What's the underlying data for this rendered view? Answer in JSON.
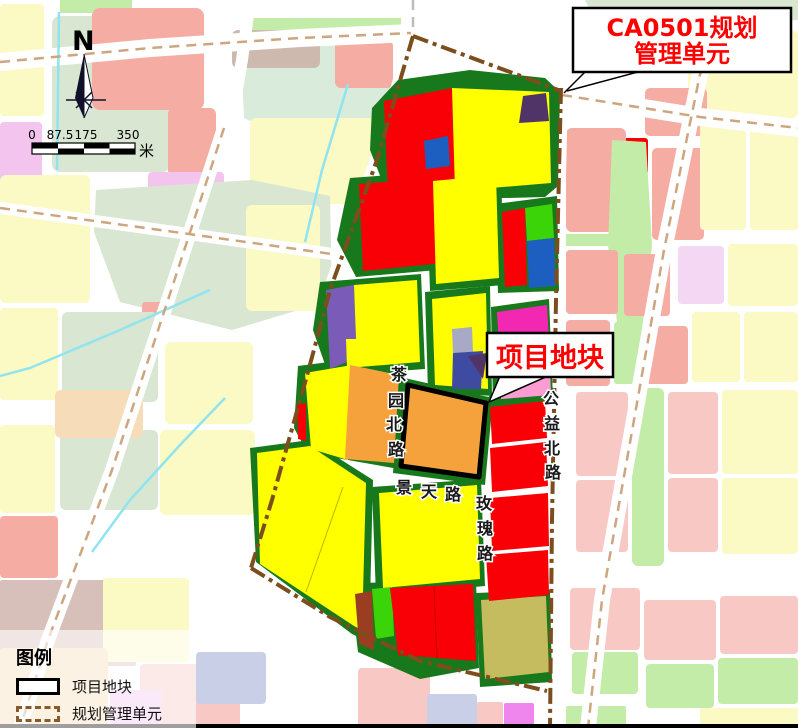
{
  "north": {
    "label": "N"
  },
  "scalebar": {
    "ticks": [
      "0",
      "87.5",
      "175",
      "350"
    ],
    "unit": "米"
  },
  "legend": {
    "title": "图例",
    "items": [
      {
        "symbol": "project-outline",
        "label": "项目地块"
      },
      {
        "symbol": "unit-dash",
        "label": "规划管理单元"
      }
    ]
  },
  "annotations": {
    "unit_box": {
      "lines": [
        "CA0501规划",
        "管理单元"
      ],
      "leaders": [
        [
          585,
          72,
          564,
          93
        ],
        [
          638,
          72,
          567,
          91
        ]
      ]
    },
    "project_box": {
      "text": "项目地块",
      "tail": "500,376 548,376 489,402"
    }
  },
  "labels": {
    "roads": [
      {
        "name": "茶园北路",
        "chars": [
          [
            "茶",
            399,
            374
          ],
          [
            "园",
            396,
            400
          ],
          [
            "北",
            394,
            424
          ],
          [
            "路",
            396,
            449
          ]
        ]
      },
      {
        "name": "景天路",
        "chars": [
          [
            "景",
            404,
            487
          ],
          [
            "天",
            429,
            491
          ],
          [
            "路",
            453,
            494
          ]
        ]
      },
      {
        "name": "玫瑰路",
        "chars": [
          [
            "玫",
            484,
            503
          ],
          [
            "瑰",
            485,
            528
          ],
          [
            "路",
            485,
            553
          ]
        ]
      },
      {
        "name": "公益北路",
        "chars": [
          [
            "公",
            551,
            398
          ],
          [
            "益",
            552,
            423
          ],
          [
            "北",
            552,
            448
          ],
          [
            "路",
            553,
            472
          ]
        ]
      }
    ]
  },
  "palette": {
    "paleYellow": "#FBF9C4",
    "sage": "#D9E6D2",
    "salmon": "#F5ACA3",
    "pinkLight": "#F8C8C4",
    "dustyRose": "#D8C0BA",
    "orchid": "#F2C4EE",
    "violet": "#EE86EE",
    "peach": "#F6DCB8",
    "lavender": "#C9CFE6",
    "taupe": "#CDB9AE",
    "mint": "#D9ECDC",
    "lightGreen": "#C2ECA8",
    "paleViolet": "#F4D7F3",
    "yellow": "#FFFF00",
    "red": "#F90006",
    "orange": "#F5A23C",
    "greenBand": "#17781C",
    "brightGreen": "#3BD409",
    "blue": "#1C5FC0",
    "purple": "#7A5CB8",
    "darkPurple": "#503468",
    "slateBlue": "#3F4BA0",
    "grayLav": "#A7A9C5",
    "magenta": "#F328B2",
    "pink": "#FB9CD2",
    "olive": "#C5BC60",
    "brown": "#9A3D20",
    "boundary": "#7C4E1D",
    "tanRoad": "#CDA57E",
    "stream": "#8FE4EF",
    "labelRed": "#FF0000"
  },
  "map": {
    "bg_parcels": [
      {
        "t": "rect",
        "x": 60,
        "y": 0,
        "w": 72,
        "h": 13,
        "f": "lightGreen"
      },
      {
        "t": "rect",
        "x": 0,
        "y": 4,
        "w": 44,
        "h": 112,
        "r": 4,
        "f": "paleYellow"
      },
      {
        "t": "rect",
        "x": 52,
        "y": 16,
        "w": 118,
        "h": 156,
        "r": 8,
        "f": "sage"
      },
      {
        "t": "rect",
        "x": 92,
        "y": 8,
        "w": 112,
        "h": 102,
        "r": 8,
        "f": "salmon"
      },
      {
        "t": "rect",
        "x": 168,
        "y": 108,
        "w": 48,
        "h": 68,
        "r": 6,
        "f": "salmon"
      },
      {
        "t": "rect",
        "x": 0,
        "y": 122,
        "w": 42,
        "h": 116,
        "r": 4,
        "f": "orchid"
      },
      {
        "t": "poly",
        "pts": "240,30 392,30 392,140 298,145 244,118",
        "f": "mint"
      },
      {
        "t": "rect",
        "x": 243,
        "y": 18,
        "w": 158,
        "h": 13,
        "f": "lightGreen"
      },
      {
        "t": "rect",
        "x": 232,
        "y": 30,
        "w": 88,
        "h": 38,
        "r": 6,
        "f": "taupe"
      },
      {
        "t": "rect",
        "x": 335,
        "y": 40,
        "w": 58,
        "h": 48,
        "r": 6,
        "f": "salmon"
      },
      {
        "t": "rect",
        "x": 250,
        "y": 118,
        "w": 148,
        "h": 86,
        "r": 6,
        "f": "paleYellow"
      },
      {
        "t": "rect",
        "x": 148,
        "y": 172,
        "w": 76,
        "h": 34,
        "r": 4,
        "f": "orchid"
      },
      {
        "t": "poly",
        "pts": "96,190 252,180 330,196 332,300 232,330 120,302 94,232",
        "f": "sage"
      },
      {
        "t": "rect",
        "x": 0,
        "y": 175,
        "w": 90,
        "h": 128,
        "r": 6,
        "f": "paleYellow"
      },
      {
        "t": "rect",
        "x": 246,
        "y": 205,
        "w": 74,
        "h": 106,
        "r": 6,
        "f": "paleYellow"
      },
      {
        "t": "rect",
        "x": 142,
        "y": 302,
        "w": 24,
        "h": 22,
        "r": 3,
        "f": "salmon"
      },
      {
        "t": "rect",
        "x": 0,
        "y": 308,
        "w": 58,
        "h": 92,
        "r": 4,
        "f": "paleYellow"
      },
      {
        "t": "rect",
        "x": 62,
        "y": 312,
        "w": 96,
        "h": 90,
        "r": 6,
        "f": "sage"
      },
      {
        "t": "rect",
        "x": 60,
        "y": 430,
        "w": 98,
        "h": 80,
        "r": 6,
        "f": "sage"
      },
      {
        "t": "rect",
        "x": 55,
        "y": 390,
        "w": 88,
        "h": 48,
        "r": 6,
        "f": "peach"
      },
      {
        "t": "rect",
        "x": 165,
        "y": 342,
        "w": 88,
        "h": 82,
        "r": 6,
        "f": "paleYellow"
      },
      {
        "t": "rect",
        "x": 160,
        "y": 430,
        "w": 95,
        "h": 85,
        "r": 6,
        "f": "paleYellow"
      },
      {
        "t": "rect",
        "x": 0,
        "y": 425,
        "w": 55,
        "h": 88,
        "r": 4,
        "f": "paleYellow"
      },
      {
        "t": "rect",
        "x": 0,
        "y": 516,
        "w": 58,
        "h": 62,
        "r": 4,
        "f": "salmon"
      },
      {
        "t": "rect",
        "x": 0,
        "y": 580,
        "w": 136,
        "h": 86,
        "r": 2,
        "f": "dustyRose"
      },
      {
        "t": "rect",
        "x": 103,
        "y": 578,
        "w": 86,
        "h": 84,
        "r": 4,
        "f": "paleYellow"
      },
      {
        "t": "rect",
        "x": 0,
        "y": 648,
        "w": 108,
        "h": 80,
        "r": 4,
        "f": "peach"
      },
      {
        "t": "rect",
        "x": 140,
        "y": 664,
        "w": 100,
        "h": 64,
        "r": 4,
        "f": "pinkLight"
      },
      {
        "t": "rect",
        "x": 196,
        "y": 652,
        "w": 70,
        "h": 52,
        "r": 4,
        "f": "lavender"
      },
      {
        "t": "rect",
        "x": 110,
        "y": 690,
        "w": 52,
        "h": 38,
        "r": 3,
        "f": "orchid"
      },
      {
        "t": "rect",
        "x": 358,
        "y": 668,
        "w": 72,
        "h": 60,
        "r": 4,
        "f": "pinkLight"
      },
      {
        "t": "rect",
        "x": 427,
        "y": 694,
        "w": 50,
        "h": 34,
        "r": 3,
        "f": "lavender"
      },
      {
        "t": "rect",
        "x": 477,
        "y": 702,
        "w": 26,
        "h": 26,
        "r": 2,
        "f": "pinkLight"
      },
      {
        "t": "rect",
        "x": 504,
        "y": 703,
        "w": 30,
        "h": 25,
        "r": 2,
        "f": "violet"
      },
      {
        "t": "poly",
        "pts": "585,0 798,0 798,20 600,30",
        "f": "sage"
      },
      {
        "t": "rect",
        "x": 688,
        "y": 30,
        "w": 110,
        "h": 88,
        "r": 6,
        "f": "paleYellow"
      },
      {
        "t": "rect",
        "x": 645,
        "y": 88,
        "w": 62,
        "h": 48,
        "r": 5,
        "f": "salmon"
      },
      {
        "t": "rect",
        "x": 598,
        "y": 138,
        "w": 50,
        "h": 36,
        "r": 3,
        "f": "red"
      },
      {
        "t": "rect",
        "x": 566,
        "y": 128,
        "w": 60,
        "h": 104,
        "r": 6,
        "f": "salmon"
      },
      {
        "t": "rect",
        "x": 566,
        "y": 234,
        "w": 60,
        "h": 12,
        "f": "lightGreen"
      },
      {
        "t": "poly",
        "pts": "612,140 646,142 652,246 642,330 618,330 608,246",
        "f": "lightGreen"
      },
      {
        "t": "rect",
        "x": 652,
        "y": 148,
        "w": 52,
        "h": 92,
        "r": 5,
        "f": "salmon"
      },
      {
        "t": "rect",
        "x": 700,
        "y": 120,
        "w": 46,
        "h": 110,
        "r": 4,
        "f": "paleYellow"
      },
      {
        "t": "rect",
        "x": 750,
        "y": 122,
        "w": 48,
        "h": 108,
        "r": 4,
        "f": "paleYellow"
      },
      {
        "t": "rect",
        "x": 566,
        "y": 250,
        "w": 52,
        "h": 64,
        "r": 4,
        "f": "salmon"
      },
      {
        "t": "rect",
        "x": 624,
        "y": 254,
        "w": 46,
        "h": 62,
        "r": 4,
        "f": "salmon"
      },
      {
        "t": "rect",
        "x": 678,
        "y": 246,
        "w": 46,
        "h": 58,
        "r": 4,
        "f": "paleViolet"
      },
      {
        "t": "rect",
        "x": 728,
        "y": 244,
        "w": 70,
        "h": 62,
        "r": 4,
        "f": "paleYellow"
      },
      {
        "t": "rect",
        "x": 566,
        "y": 320,
        "w": 44,
        "h": 66,
        "r": 4,
        "f": "salmon"
      },
      {
        "t": "rect",
        "x": 614,
        "y": 322,
        "w": 28,
        "h": 62,
        "r": 3,
        "f": "lightGreen"
      },
      {
        "t": "rect",
        "x": 646,
        "y": 326,
        "w": 42,
        "h": 58,
        "r": 4,
        "f": "salmon"
      },
      {
        "t": "rect",
        "x": 692,
        "y": 312,
        "w": 48,
        "h": 70,
        "r": 4,
        "f": "paleYellow"
      },
      {
        "t": "rect",
        "x": 744,
        "y": 312,
        "w": 54,
        "h": 70,
        "r": 4,
        "f": "paleYellow"
      },
      {
        "t": "rect",
        "x": 576,
        "y": 392,
        "w": 52,
        "h": 84,
        "r": 4,
        "f": "pinkLight"
      },
      {
        "t": "rect",
        "x": 632,
        "y": 388,
        "w": 32,
        "h": 178,
        "r": 6,
        "f": "lightGreen"
      },
      {
        "t": "rect",
        "x": 668,
        "y": 392,
        "w": 50,
        "h": 82,
        "r": 4,
        "f": "pinkLight"
      },
      {
        "t": "rect",
        "x": 722,
        "y": 390,
        "w": 76,
        "h": 84,
        "r": 4,
        "f": "paleYellow"
      },
      {
        "t": "rect",
        "x": 576,
        "y": 480,
        "w": 52,
        "h": 72,
        "r": 4,
        "f": "pinkLight"
      },
      {
        "t": "rect",
        "x": 668,
        "y": 478,
        "w": 50,
        "h": 74,
        "r": 4,
        "f": "pinkLight"
      },
      {
        "t": "rect",
        "x": 722,
        "y": 478,
        "w": 76,
        "h": 76,
        "r": 4,
        "f": "paleYellow"
      },
      {
        "t": "rect",
        "x": 570,
        "y": 588,
        "w": 70,
        "h": 62,
        "r": 4,
        "f": "pinkLight"
      },
      {
        "t": "rect",
        "x": 572,
        "y": 652,
        "w": 66,
        "h": 42,
        "r": 4,
        "f": "lightGreen"
      },
      {
        "t": "rect",
        "x": 644,
        "y": 600,
        "w": 72,
        "h": 60,
        "r": 4,
        "f": "pinkLight"
      },
      {
        "t": "rect",
        "x": 646,
        "y": 664,
        "w": 68,
        "h": 44,
        "r": 4,
        "f": "lightGreen"
      },
      {
        "t": "rect",
        "x": 720,
        "y": 596,
        "w": 78,
        "h": 58,
        "r": 4,
        "f": "pinkLight"
      },
      {
        "t": "rect",
        "x": 718,
        "y": 658,
        "w": 80,
        "h": 46,
        "r": 4,
        "f": "lightGreen"
      },
      {
        "t": "rect",
        "x": 566,
        "y": 706,
        "w": 60,
        "h": 22,
        "r": 2,
        "f": "lightGreen"
      },
      {
        "t": "rect",
        "x": 700,
        "y": 708,
        "w": 98,
        "h": 20,
        "r": 2,
        "f": "paleYellow"
      }
    ],
    "roads_white": [
      {
        "pts": "0,62 150,48 300,38 411,33",
        "w": 18
      },
      {
        "pts": "562,95 700,117 798,128",
        "w": 18
      },
      {
        "pts": "224,128 168,300 112,470 48,640 20,728",
        "w": 14
      },
      {
        "pts": "0,208 160,230 332,254",
        "w": 12
      },
      {
        "pts": "705,50 664,250 634,420 602,600 588,728",
        "w": 16
      },
      {
        "pts": "250,0 242,60 230,130",
        "w": 12
      },
      {
        "pts": "413,0 413,33",
        "w": 16
      },
      {
        "pts": "250,568 330,616 420,660 548,692",
        "w": 16
      },
      {
        "pts": "413,34 377,160 330,290 308,372 272,500 252,568",
        "w": 14
      },
      {
        "pts": "561,88 554,400 550,728",
        "w": 14
      }
    ],
    "streams": [
      {
        "pts": "59,12 57,170"
      },
      {
        "pts": "348,84 322,170 305,242"
      },
      {
        "pts": "210,290 120,330 30,368 0,376"
      },
      {
        "pts": "225,398 180,445 130,500 92,552"
      }
    ],
    "road_dashes": [
      {
        "pts": "0,62 150,48 300,38 411,33",
        "c": "tanRoad"
      },
      {
        "pts": "562,95 700,117 798,128",
        "c": "tanRoad"
      },
      {
        "pts": "224,128 168,300 112,470 48,640 20,728",
        "c": "tanRoad"
      },
      {
        "pts": "0,208 160,230 332,254",
        "c": "tanRoad"
      },
      {
        "pts": "705,50 664,250 634,420 602,600 588,728",
        "c": "tanRoad"
      },
      {
        "pts": "413,0 413,30",
        "c": "#BDBDBD"
      }
    ],
    "blocks": [
      {
        "pts": "372,108 398,80 470,70 545,78 560,92 558,186 545,197 390,201 370,150"
      },
      {
        "pts": "350,178 446,171 449,269 356,277 337,240"
      },
      {
        "pts": "426,174 501,168 504,285 430,291"
      },
      {
        "pts": "495,204 557,196 559,291 498,293"
      },
      {
        "pts": "320,282 421,274 425,369 329,376 313,330"
      },
      {
        "pts": "425,292 490,286 492,396 428,391"
      },
      {
        "pts": "491,307 549,299 553,399 493,403"
      },
      {
        "pts": "298,366 360,358 406,371 399,469 308,453 294,428"
      },
      {
        "pts": "400,377 493,398 485,485 393,473"
      },
      {
        "pts": "250,448 310,440 373,480 369,642 352,634 256,562"
      },
      {
        "pts": "372,487 481,479 485,586 376,596"
      },
      {
        "pts": "350,583 476,581 479,668 420,679 358,652"
      },
      {
        "pts": "476,593 550,590 552,682 480,687"
      },
      {
        "pts": "489,396 548,390 549,404 490,410"
      }
    ],
    "parcels": [
      {
        "pts": "384,101 452,88 455,191 388,194",
        "f": "red"
      },
      {
        "pts": "452,88 549,92 551,183 455,191",
        "f": "yellow"
      },
      {
        "pts": "523,96 546,93 549,121 519,123",
        "f": "darkPurple"
      },
      {
        "pts": "424,141 448,136 450,166 426,169",
        "f": "blue"
      },
      {
        "pts": "359,184 440,178 443,263 363,271",
        "f": "red"
      },
      {
        "pts": "433,181 496,175 499,278 436,284",
        "f": "yellow"
      },
      {
        "pts": "502,212 525,208 527,285 505,287",
        "f": "red"
      },
      {
        "pts": "525,208 552,204 554,238 527,241",
        "f": "brightGreen"
      },
      {
        "pts": "527,241 554,238 556,286 529,288",
        "f": "blue"
      },
      {
        "pts": "326,290 354,285 356,339 346,339 347,362 330,369",
        "f": "purple"
      },
      {
        "pts": "354,285 417,280 420,362 347,368 346,339 356,339",
        "f": "yellow"
      },
      {
        "pts": "432,299 486,293 488,389 435,385",
        "f": "yellow"
      },
      {
        "pts": "452,329 472,327 473,352 453,353",
        "f": "grayLav"
      },
      {
        "pts": "453,353 483,351 481,389 452,389",
        "f": "slateBlue"
      },
      {
        "pts": "468,356 487,353 483,379",
        "f": "darkPurple"
      },
      {
        "pts": "497,312 547,305 549,341 499,347",
        "f": "magenta"
      },
      {
        "pts": "499,347 549,341 551,395 501,399",
        "f": "pink"
      },
      {
        "pts": "305,373 352,365 348,460 311,449",
        "f": "yellow"
      },
      {
        "pts": "350,365 399,375 394,463 345,459",
        "f": "orange"
      },
      {
        "pts": "297,405 306,403 306,441 298,439",
        "f": "red"
      },
      {
        "pts": "257,453 310,446 366,483 362,630 354,626 260,564",
        "f": "yellow"
      },
      {
        "pts": "379,493 477,485 480,579 383,588",
        "f": "yellow"
      },
      {
        "pts": "355,594 372,591 374,650 359,644",
        "f": "brown"
      },
      {
        "pts": "372,589 392,587 394,636 376,639",
        "f": "brightGreen"
      },
      {
        "pts": "390,588 473,584 476,661 398,655",
        "f": "red"
      },
      {
        "pts": "481,600 546,596 549,672 485,679",
        "f": "olive"
      },
      {
        "pts": "490,407 545,401 547,438 492,444",
        "f": "red"
      },
      {
        "pts": "490,448 546,442 548,486 492,492",
        "f": "red"
      },
      {
        "pts": "490,498 548,493 549,546 492,551",
        "f": "red"
      },
      {
        "pts": "486,555 548,550 549,595 489,601",
        "f": "red"
      }
    ],
    "thin_lines": [
      {
        "pts": "343,487 306,592",
        "c": "#B8B800"
      },
      {
        "pts": "434,586 437,658",
        "c": "#C00000"
      }
    ],
    "boundary": [
      {
        "pts": "413,36 561,91"
      },
      {
        "pts": "561,88 556,300 552,520 550,728"
      },
      {
        "pts": "413,36 377,160 330,290 308,372 272,500 251,568"
      },
      {
        "pts": "251,568 330,617 420,661 547,691"
      }
    ],
    "project_parcel": {
      "pts": "408,385 486,403 479,477 401,466",
      "f": "orange"
    }
  }
}
